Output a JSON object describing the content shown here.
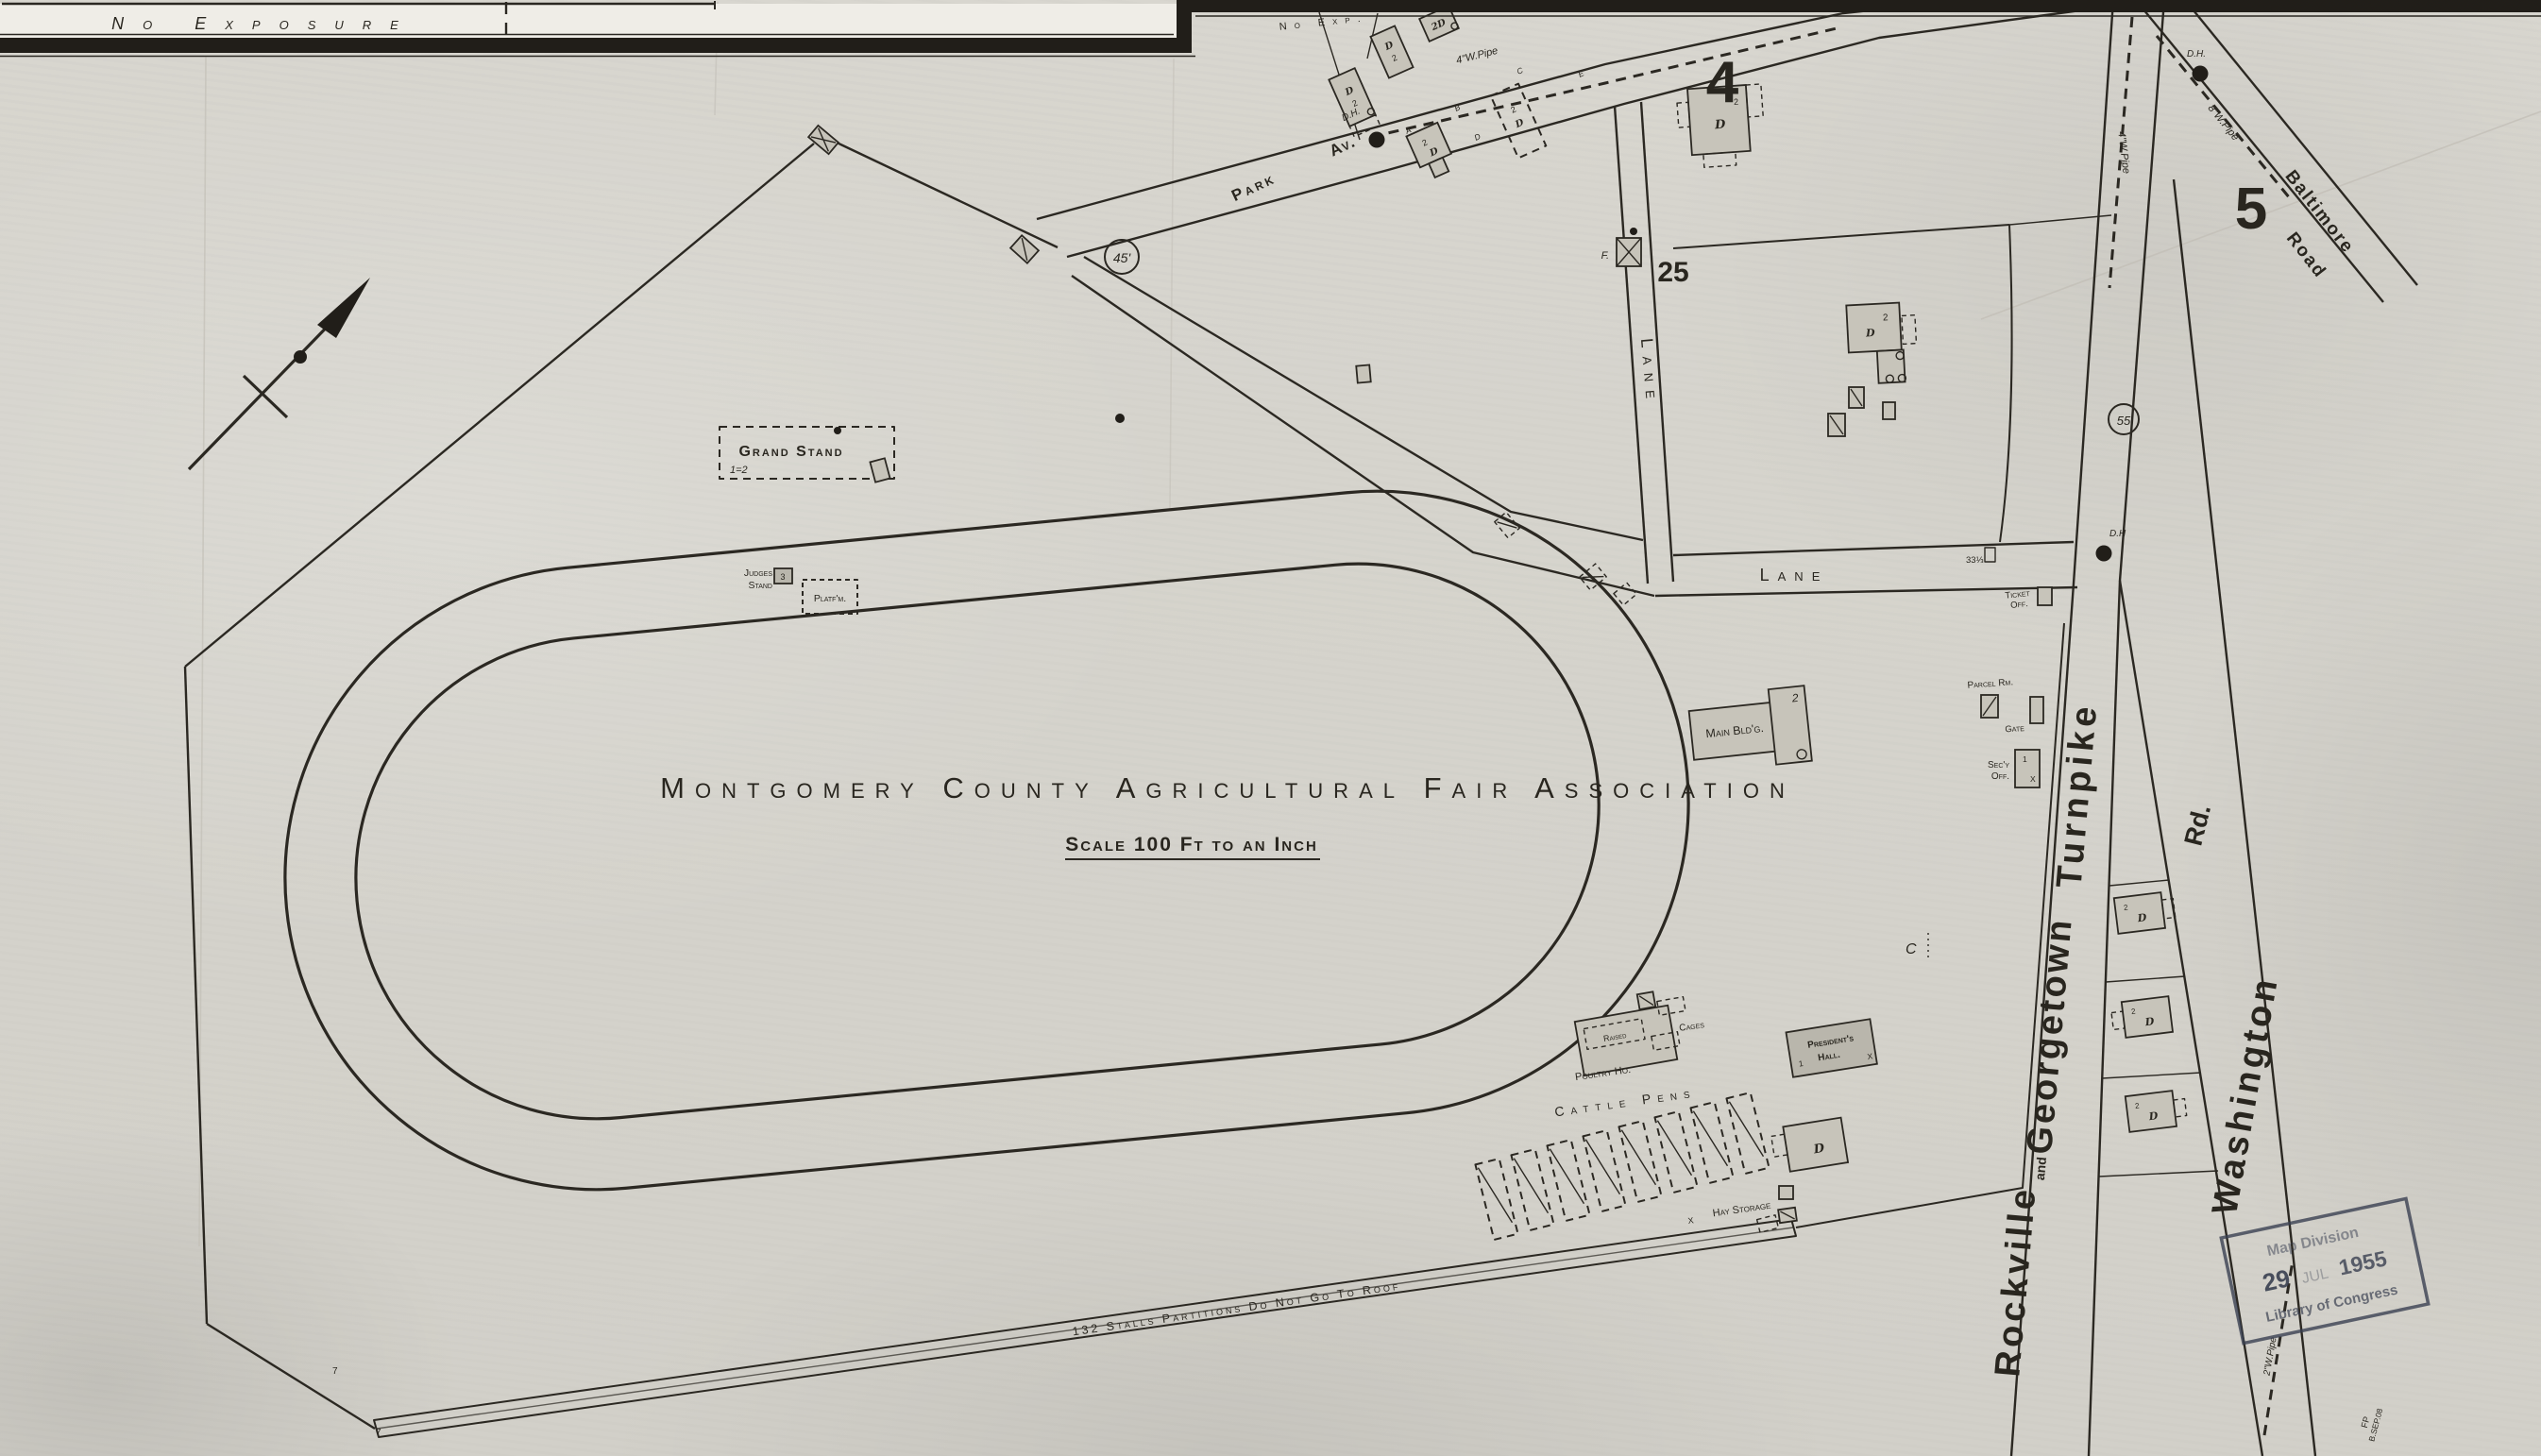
{
  "banner": {
    "no_exposure": "No Exposure",
    "no_exp": "No Exp."
  },
  "title": {
    "main": "Montgomery County Agricultural Fair Association",
    "scale": "Scale 100 Ft to an Inch"
  },
  "blocks": {
    "n4": "4",
    "n5": "5",
    "n25": "25"
  },
  "circled": {
    "gate_width": "45'",
    "route": "55"
  },
  "streets": {
    "park": "Park",
    "park_suffix": "Av.",
    "lane_v": "Lane",
    "lane_h": "Lane",
    "lane_width": "33⅓",
    "rockville": "Rockville",
    "and": "and",
    "georgetown": "Georgetown",
    "turnpike": "Turnpike",
    "washington": "Washington",
    "rd": "Rd.",
    "baltimore": "Baltimore",
    "road": "Road"
  },
  "utilities": {
    "dh": "D.H.",
    "dh_short": "D.H",
    "pipe_park": "4\"W.Pipe",
    "pipe_turnpike": "4\"W.Pipe",
    "pipe_baltimore": "8\"W.Pipe",
    "pipe_washington": "2\"W.Pipe",
    "curb_a": "A",
    "curb_b": "B",
    "curb_c": "C",
    "curb_d": "D",
    "curb_e": "E"
  },
  "buildings": {
    "grand_stand": "Grand Stand",
    "grand_stand_note": "1=2",
    "judges_1": "Judges",
    "judges_2": "Stand",
    "judges_num": "3",
    "platform": "Platf'm.",
    "main_bldg": "Main Bld'g.",
    "parcel": "Parcel Rm.",
    "gate": "Gate",
    "secy_1": "Sec'y",
    "secy_2": "Off.",
    "ticket_1": "Ticket",
    "ticket_2": "Off.",
    "presidents_1": "President's",
    "presidents_2": "Hall.",
    "poultry": "Poultry Ho.",
    "raised": "Raised",
    "cages": "Cages",
    "cattle_pens": "Cattle Pens",
    "hay_storage": "Hay Storage",
    "stalls": "132 Stalls  Partitions Do Not Go To Roof",
    "f_label": "F.",
    "dwelling": "D",
    "two": "2",
    "one": "1",
    "x": "X",
    "two_d": "2D"
  },
  "stamp": {
    "l1": "Map Division",
    "l2a": "29",
    "l2b": "JUL",
    "l2c": "1955",
    "l3": "Library of Congress"
  },
  "corner": {
    "l1": "FP",
    "l2": "B.SEP.08"
  },
  "misc": {
    "c": "C",
    "seven": "7"
  }
}
